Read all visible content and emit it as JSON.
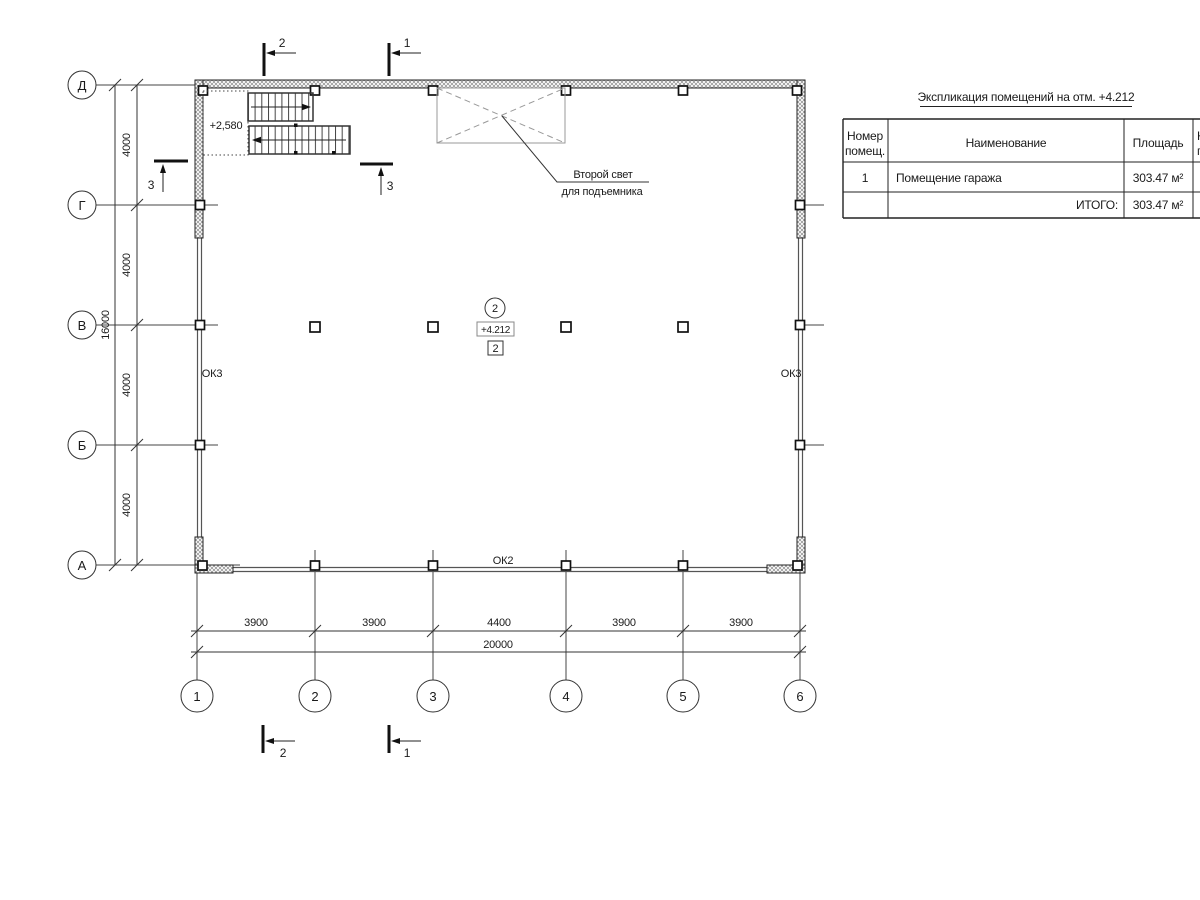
{
  "table": {
    "title": "Экспликация помещений на отм. +4.212",
    "header": {
      "number_l1": "Номер",
      "number_l2": "помещ.",
      "name": "Наименование",
      "area": "Площадь",
      "cut_l1": "К",
      "cut_l2": "п"
    },
    "row": {
      "number": "1",
      "name": "Помещение гаража",
      "area": "303.47 м²"
    },
    "total": {
      "label": "ИТОГО:",
      "area": "303.47 м²"
    }
  },
  "plan": {
    "windows": {
      "left": "ОК3",
      "right": "ОК3",
      "bottom": "ОК2"
    },
    "stair_elevation": "+2,580",
    "room_tag": {
      "number": "2",
      "elevation": "+4.212",
      "mark": "2"
    },
    "annotation": {
      "l1": "Второй свет",
      "l2": "для подъемника"
    }
  },
  "sections": {
    "s1": "1",
    "s2": "2",
    "s3": "3"
  },
  "grid": {
    "columns": [
      "1",
      "2",
      "3",
      "4",
      "5",
      "6"
    ],
    "rows": [
      "Д",
      "Г",
      "В",
      "Б",
      "А"
    ]
  },
  "dims": {
    "bottom": [
      "3900",
      "3900",
      "4400",
      "3900",
      "3900"
    ],
    "bottom_total": "20000",
    "left": [
      "4000",
      "4000",
      "4000",
      "4000"
    ],
    "left_total": "16000"
  }
}
